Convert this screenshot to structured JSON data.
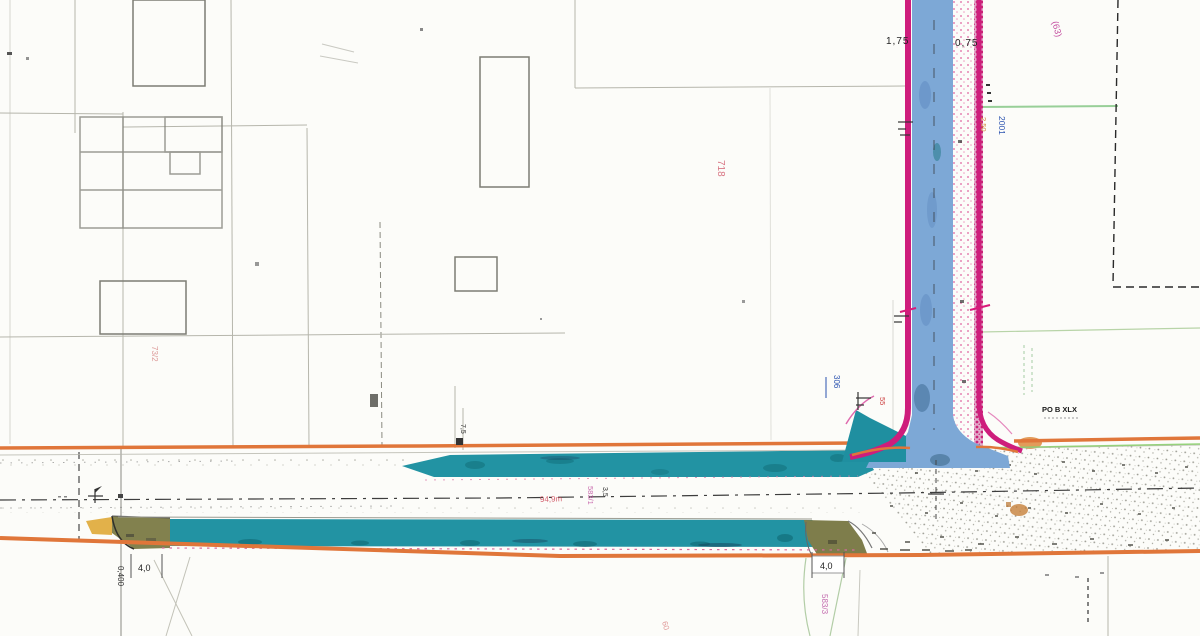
{
  "drawing": {
    "title": "road-construction-site-plan",
    "labels": {
      "dim_left_top": "1,75",
      "dim_right_top": "0,75",
      "parcel_top_right": "(63)",
      "parcel_center": "718",
      "parcel_left": "73/2",
      "utility_blue": "2001",
      "dim_orange": "2,50",
      "marker_blue": "306",
      "marker_red": "55",
      "survey_point": "PO B XLX",
      "dim_width_small": "7,5",
      "length_label": "94,9m",
      "parcel_mid_road": "583/1",
      "dim_road": "3,5",
      "dim_drive_left": "4,0",
      "station_left": "0,400",
      "dim_drive_center": "4,0",
      "parcel_bottom_center": "583/3",
      "parcel_bottom": "60"
    },
    "colors": {
      "corridor_outline_orange": "#e0763a",
      "road_edge_magenta": "#ce1d7c",
      "carriageway_blue": "#7da8d6",
      "pavement_teal": "#22929f",
      "driveway_olive": "#82814e",
      "accent_yellow": "#e2b14a",
      "centerline_black": "#3d3d3d",
      "parcel_line_gray": "#b6b6ac",
      "survey_green": "#98cf98",
      "red_text": "#cc4455",
      "blue_text": "#2a52b0"
    }
  }
}
